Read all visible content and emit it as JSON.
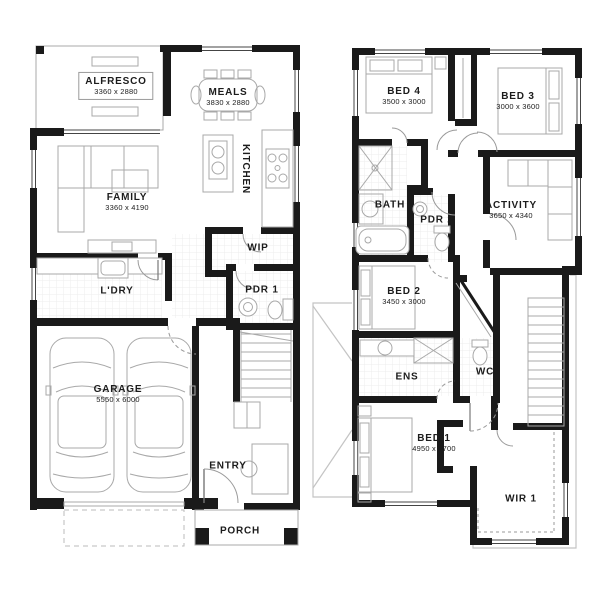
{
  "title": "Two storey home floor plan",
  "colors": {
    "wall": "#1a1a1a",
    "fixture": "#a8a8a8",
    "tile": "#e8e8e8",
    "text": "#1c1c1c",
    "background": "#ffffff"
  },
  "ground_floor": {
    "name": "Ground floor",
    "rooms": [
      {
        "id": "alfresco",
        "label": "ALFRESCO",
        "dims": "3360 x 2880"
      },
      {
        "id": "meals",
        "label": "MEALS",
        "dims": "3830 x 2880"
      },
      {
        "id": "family",
        "label": "FAMILY",
        "dims": "3360 x 4190"
      },
      {
        "id": "kitchen",
        "label": "KITCHEN",
        "dims": ""
      },
      {
        "id": "wip",
        "label": "WIP",
        "dims": ""
      },
      {
        "id": "ldry",
        "label": "L'DRY",
        "dims": ""
      },
      {
        "id": "pdr1",
        "label": "PDR 1",
        "dims": ""
      },
      {
        "id": "garage",
        "label": "GARAGE",
        "dims": "5550 x 6000"
      },
      {
        "id": "entry",
        "label": "ENTRY",
        "dims": ""
      },
      {
        "id": "porch",
        "label": "PORCH",
        "dims": ""
      }
    ]
  },
  "upper_floor": {
    "name": "Upper floor",
    "rooms": [
      {
        "id": "bed4",
        "label": "BED 4",
        "dims": "3500 x 3000"
      },
      {
        "id": "bed3",
        "label": "BED 3",
        "dims": "3000 x 3600"
      },
      {
        "id": "bath",
        "label": "BATH",
        "dims": ""
      },
      {
        "id": "pdr2",
        "label": "PDR 2",
        "dims": ""
      },
      {
        "id": "activity",
        "label": "ACTIVITY",
        "dims": "3650 x 4340"
      },
      {
        "id": "bed2",
        "label": "BED 2",
        "dims": "3450 x 3000"
      },
      {
        "id": "ens",
        "label": "ENS",
        "dims": ""
      },
      {
        "id": "wc",
        "label": "WC",
        "dims": ""
      },
      {
        "id": "bed1",
        "label": "BED 1",
        "dims": "4950 x 3700"
      },
      {
        "id": "wir1",
        "label": "WIR 1",
        "dims": ""
      }
    ]
  }
}
